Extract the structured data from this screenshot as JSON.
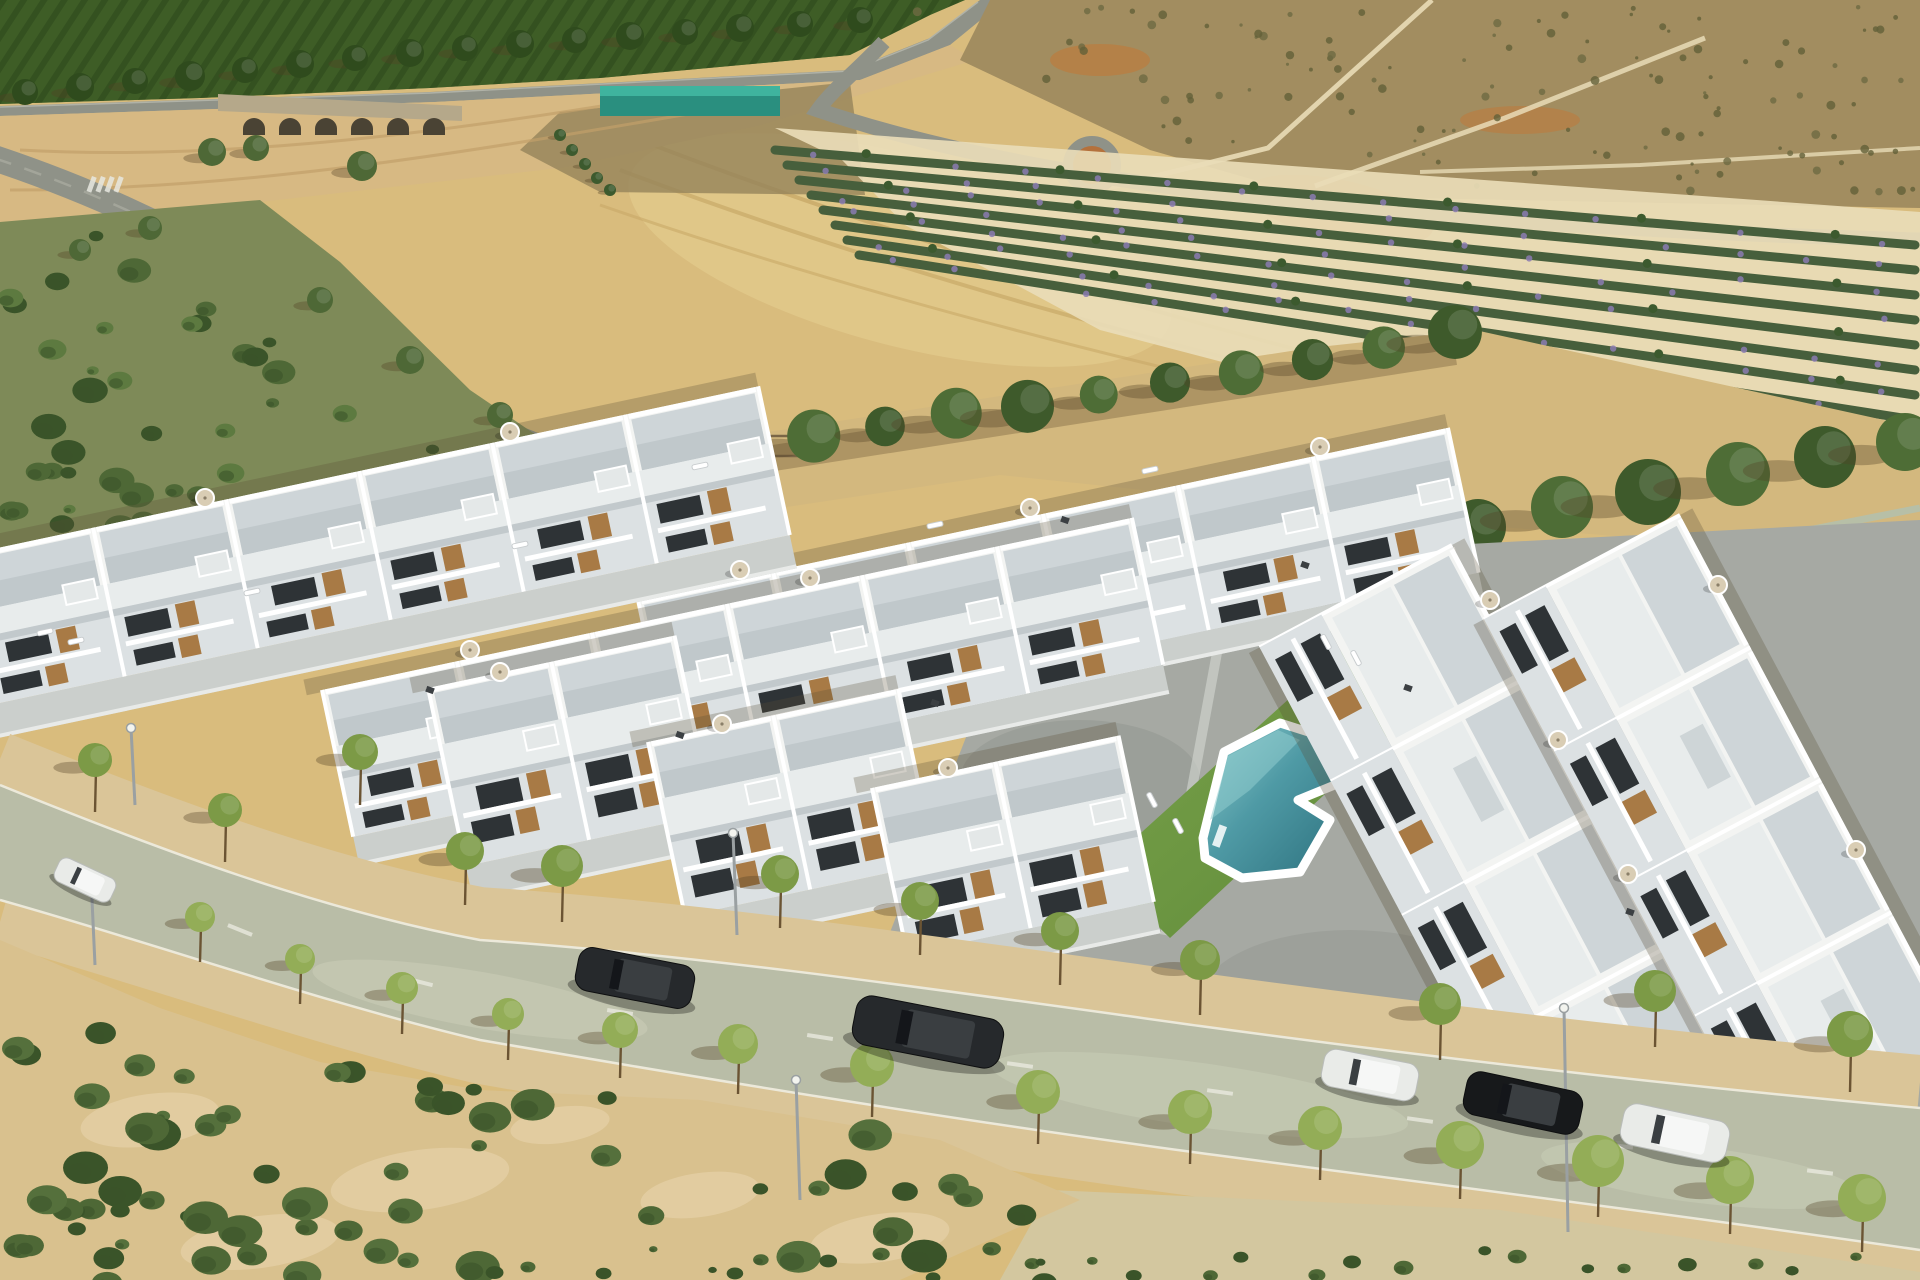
{
  "palette": {
    "sand_field": "#d9bc7d",
    "field_light": "#e7d193",
    "field_track": "#c8a968",
    "orchard_green": "#3e5d26",
    "orchard_dark": "#2f4b1d",
    "road_grey": "#8f9288",
    "road_light": "#b0b2a7",
    "wash_sand": "#d7b983",
    "wash_dark": "#c2a069",
    "wash_olive": "#95835a",
    "bridge_stone": "#b5a88a",
    "arch_dark": "#4a4334",
    "shed_teal": "#2a8f7f",
    "shed_teal2": "#3fb49e",
    "hut_tan": "#c09758",
    "roundabout": "#b4713c",
    "scrub_tr": "#a28d60",
    "scrub_tr_dark": "#636038",
    "dirt_orange": "#bc7c3e",
    "path_cream": "#e9dcb7",
    "lav_green": "#475f3c",
    "lav_purple": "#8b7bb0",
    "lav_tree": "#3c5a2e",
    "scrub_left": "#7e8a58",
    "bush_mid": "#4e6836",
    "bush_dark": "#3a5429",
    "park_sand": "#d3b87e",
    "pine": "#4e6d36",
    "pine_dark": "#3e5a2b",
    "tree_shadow": "#544326",
    "bld_white": "#f3f4f2",
    "bld_mid": "#e8ecec",
    "terr_floor": "#ced5d8",
    "terr_dark": "#b4bdc1",
    "bld_shade": "#dce1e3",
    "fac_shadow": "#c2c9cc",
    "win_dark": "#2e3336",
    "wood": "#a87a45",
    "patio": "#cbcfcc",
    "court": "#a6a9a3",
    "court_dark": "#8d908a",
    "deck_dark": "#72766f",
    "lawn": "#7ba44b",
    "lawn_dark": "#5e8939",
    "pool1": "#8fcccd",
    "pool2": "#4f9aa5",
    "pool3": "#2d717e",
    "street": "#b9bda7",
    "street_light": "#cdd0ba",
    "side_sand": "#dac598",
    "kerb": "#ece9da",
    "scrub_bl_sand": "#d9c18e",
    "car_dark": "#26292c",
    "car_black": "#17191b",
    "car_white": "#e9ebe8",
    "lamp": "#9aa0a2",
    "white": "#ffffff",
    "parasol": "#d9cdb4",
    "fence": "#aec2b5",
    "street_tree": "#7c9a46",
    "street_tree_hi": "#93ad57",
    "trunk": "#6b5433"
  },
  "terrain": {
    "bridge_arches": {
      "x0": 243,
      "step": 36,
      "count": 6,
      "y": 121,
      "r": 11
    },
    "orchard_edge_trees": [
      [
        25,
        92,
        13
      ],
      [
        80,
        87,
        14
      ],
      [
        135,
        81,
        13
      ],
      [
        190,
        76,
        15
      ],
      [
        245,
        70,
        13
      ],
      [
        300,
        64,
        14
      ],
      [
        355,
        58,
        13
      ],
      [
        410,
        53,
        14
      ],
      [
        465,
        48,
        13
      ],
      [
        520,
        44,
        14
      ],
      [
        575,
        40,
        13
      ],
      [
        630,
        36,
        14
      ],
      [
        685,
        32,
        13
      ],
      [
        740,
        28,
        14
      ],
      [
        800,
        24,
        13
      ],
      [
        860,
        20,
        13
      ]
    ],
    "left_road_trees": [
      [
        212,
        152,
        14
      ],
      [
        256,
        148,
        13
      ],
      [
        362,
        166,
        15
      ],
      [
        150,
        228,
        12
      ],
      [
        80,
        250,
        11
      ],
      [
        320,
        300,
        13
      ],
      [
        410,
        360,
        14
      ],
      [
        500,
        415,
        13
      ]
    ],
    "palm_path_trees": [
      [
        560,
        135,
        6
      ],
      [
        572,
        150,
        6
      ],
      [
        585,
        164,
        6
      ],
      [
        597,
        178,
        6
      ],
      [
        610,
        190,
        6
      ]
    ],
    "scrub_tr_speckles": {
      "count": 150
    },
    "lavender": {
      "x0": 775,
      "y0": 150,
      "x1": 1915,
      "y1": 245,
      "rows": 8,
      "gap0": 15,
      "gap1": 25,
      "dots": 16
    },
    "left_scrub_bushes": {
      "count": 70
    },
    "pines": {
      "x0": 600,
      "y0": 468,
      "x1": 1455,
      "y1": 335,
      "count": 13
    },
    "park_extra_trees": [
      [
        630,
        492,
        15
      ],
      [
        592,
        514,
        13
      ],
      [
        662,
        527,
        14
      ],
      [
        1075,
        585,
        11
      ],
      [
        1128,
        562,
        10
      ]
    ],
    "right_trees": [
      [
        1478,
        527,
        28
      ],
      [
        1562,
        507,
        31
      ],
      [
        1648,
        492,
        33
      ],
      [
        1738,
        474,
        32
      ],
      [
        1825,
        457,
        31
      ],
      [
        1905,
        442,
        29
      ]
    ],
    "bl_bushes": {
      "count": 95
    },
    "bl_sand_patches": [
      [
        150,
        1120,
        70,
        26
      ],
      [
        420,
        1180,
        90,
        30
      ],
      [
        700,
        1195,
        60,
        22
      ],
      [
        260,
        1242,
        80,
        26
      ],
      [
        560,
        1125,
        50,
        18
      ],
      [
        880,
        1238,
        70,
        24
      ]
    ],
    "tufts": {
      "count": 26,
      "x0": 470,
      "x1": 1840,
      "y0": 1248,
      "y1": 1278
    },
    "crosswalk": {
      "x": 92,
      "y": 176,
      "bars": 4,
      "step": 9
    }
  },
  "development": {
    "left_rows": [
      {
        "tx": 638,
        "ty": 600,
        "angle": -12,
        "units": 6,
        "uw": 138,
        "uh": 148,
        "patio": 26
      },
      {
        "tx": 322,
        "ty": 690,
        "angle": -12,
        "units": 6,
        "uw": 138,
        "uh": 150,
        "patio": 30
      },
      {
        "tx": -40,
        "ty": 556,
        "angle": -12,
        "units": 6,
        "uw": 136,
        "uh": 152,
        "patio": 34
      }
    ],
    "front_blocks": [
      {
        "tx": 428,
        "ty": 688,
        "angle": -12,
        "units": 2,
        "uw": 126,
        "uh": 182,
        "patio": 36
      },
      {
        "tx": 648,
        "ty": 742,
        "angle": -12,
        "units": 2,
        "uw": 128,
        "uh": 178,
        "patio": 34
      },
      {
        "tx": 872,
        "ty": 788,
        "angle": -12,
        "units": 2,
        "uw": 126,
        "uh": 170,
        "patio": 32
      }
    ],
    "right_rows": [
      {
        "tx": 1452,
        "ty": 545,
        "angle": 62,
        "units": 4,
        "uw": 152,
        "uh": 148,
        "facade": 70
      },
      {
        "tx": 1680,
        "ty": 515,
        "angle": 62,
        "units": 4,
        "uw": 150,
        "uh": 152,
        "facade": 70
      }
    ]
  },
  "street": {
    "dashes": [
      [
        80,
        872,
        25
      ],
      [
        240,
        930,
        22
      ],
      [
        420,
        982,
        14
      ],
      [
        620,
        1012,
        9
      ],
      [
        820,
        1037,
        9
      ],
      [
        1020,
        1065,
        8
      ],
      [
        1220,
        1092,
        8
      ],
      [
        1420,
        1120,
        8
      ],
      [
        1620,
        1146,
        7
      ],
      [
        1820,
        1172,
        7
      ]
    ],
    "cars": [
      {
        "x": 85,
        "y": 880,
        "w": 62,
        "h": 26,
        "angle": 25,
        "body": "car_white"
      },
      {
        "x": 635,
        "y": 978,
        "w": 118,
        "h": 44,
        "angle": 11,
        "body": "car_dark"
      },
      {
        "x": 928,
        "y": 1032,
        "w": 150,
        "h": 50,
        "angle": 11,
        "body": "car_dark"
      },
      {
        "x": 1370,
        "y": 1075,
        "w": 96,
        "h": 38,
        "angle": 11,
        "body": "car_white"
      },
      {
        "x": 1523,
        "y": 1103,
        "w": 118,
        "h": 44,
        "angle": 12,
        "body": "car_black"
      },
      {
        "x": 1675,
        "y": 1133,
        "w": 108,
        "h": 42,
        "angle": 12,
        "body": "car_white"
      }
    ],
    "lamps": [
      [
        135,
        805,
        728
      ],
      [
        737,
        935,
        833
      ],
      [
        95,
        965,
        878
      ],
      [
        800,
        1200,
        1080
      ],
      [
        1568,
        1232,
        1008
      ]
    ],
    "trees_near": [
      [
        200,
        962,
        15
      ],
      [
        300,
        1004,
        15
      ],
      [
        402,
        1034,
        16
      ],
      [
        508,
        1060,
        16
      ],
      [
        620,
        1078,
        18
      ],
      [
        738,
        1094,
        20
      ],
      [
        872,
        1117,
        22
      ],
      [
        1038,
        1144,
        22
      ],
      [
        1190,
        1164,
        22
      ],
      [
        1320,
        1180,
        22
      ],
      [
        1460,
        1199,
        24
      ],
      [
        1598,
        1217,
        26
      ],
      [
        1730,
        1234,
        24
      ],
      [
        1862,
        1252,
        24
      ]
    ],
    "trees_far": [
      [
        95,
        812,
        17
      ],
      [
        225,
        862,
        17
      ],
      [
        360,
        805,
        18
      ],
      [
        465,
        905,
        19
      ],
      [
        562,
        922,
        21
      ],
      [
        780,
        928,
        19
      ],
      [
        920,
        955,
        19
      ],
      [
        1060,
        985,
        19
      ],
      [
        1200,
        1015,
        20
      ],
      [
        1440,
        1060,
        21
      ],
      [
        1655,
        1047,
        21
      ],
      [
        1850,
        1092,
        23
      ]
    ]
  },
  "furniture": {
    "parasols": [
      [
        740,
        570
      ],
      [
        1030,
        508
      ],
      [
        1320,
        447
      ],
      [
        470,
        650
      ],
      [
        810,
        578
      ],
      [
        205,
        498
      ],
      [
        510,
        432
      ],
      [
        500,
        672
      ],
      [
        722,
        724
      ],
      [
        948,
        768
      ],
      [
        1490,
        600
      ],
      [
        1558,
        740
      ],
      [
        1628,
        874
      ],
      [
        1718,
        585
      ],
      [
        1856,
        850
      ]
    ],
    "loungers": [
      [
        45,
        632,
        -12
      ],
      [
        76,
        641,
        -12
      ],
      [
        252,
        592,
        -12
      ],
      [
        520,
        545,
        -12
      ],
      [
        700,
        466,
        -12
      ],
      [
        935,
        525,
        -12
      ],
      [
        1150,
        470,
        -12
      ],
      [
        1152,
        800,
        62
      ],
      [
        1178,
        826,
        62
      ],
      [
        1326,
        642,
        62
      ],
      [
        1356,
        658,
        62
      ]
    ],
    "dark": [
      [
        935,
        703
      ],
      [
        1305,
        565
      ],
      [
        865,
        932
      ],
      [
        1125,
        1062
      ],
      [
        1630,
        912
      ],
      [
        1065,
        520
      ],
      [
        430,
        690
      ],
      [
        680,
        735
      ],
      [
        1408,
        688
      ]
    ]
  }
}
